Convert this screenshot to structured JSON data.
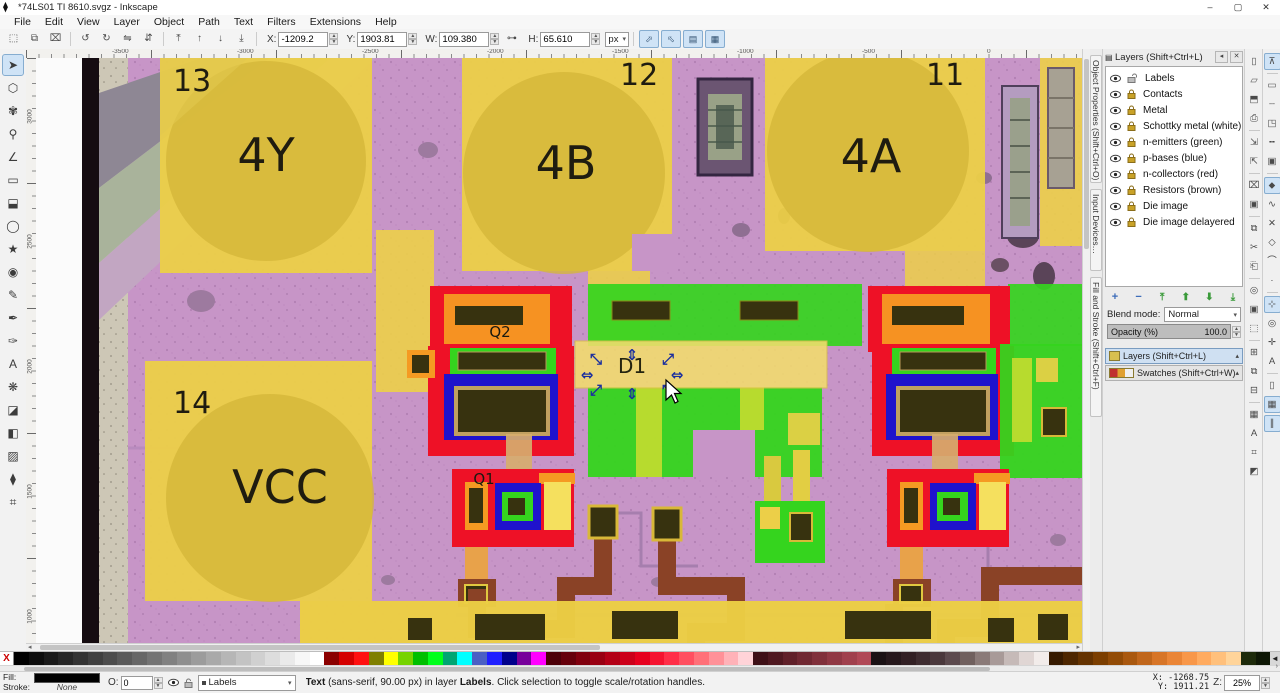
{
  "titlebar": {
    "title": "*74LS01 TI 8610.svgz - Inkscape",
    "minimize": "–",
    "maximize": "▢",
    "close": "✕",
    "appicon": "⧫"
  },
  "menubar": {
    "items": [
      "File",
      "Edit",
      "View",
      "Layer",
      "Object",
      "Path",
      "Text",
      "Filters",
      "Extensions",
      "Help"
    ]
  },
  "tool_controls": {
    "button_groups": [
      [
        {
          "name": "select-all",
          "glyph": "⬚"
        },
        {
          "name": "select-all-layers",
          "glyph": "⧉"
        },
        {
          "name": "deselect",
          "glyph": "⌧"
        }
      ],
      [
        {
          "name": "rotate-ccw",
          "glyph": "↺"
        },
        {
          "name": "rotate-cw",
          "glyph": "↻"
        },
        {
          "name": "flip-horizontal",
          "glyph": "⇋"
        },
        {
          "name": "flip-vertical",
          "glyph": "⇵"
        }
      ],
      [
        {
          "name": "raise-to-top",
          "glyph": "⤒"
        },
        {
          "name": "raise",
          "glyph": "↑"
        },
        {
          "name": "lower",
          "glyph": "↓"
        },
        {
          "name": "lower-to-bottom",
          "glyph": "⤓"
        }
      ]
    ],
    "fields": [
      {
        "name": "x-field",
        "label": "X:",
        "value": "-1209.2"
      },
      {
        "name": "y-field",
        "label": "Y:",
        "value": "1903.81"
      },
      {
        "name": "w-field",
        "label": "W:",
        "value": "109.380"
      },
      {
        "name": "h-field",
        "label": "H:",
        "value": "65.610"
      }
    ],
    "ratio_lock_glyph": "⊶",
    "unit": "px",
    "scale_toggles": [
      {
        "name": "scale-stroke-toggle",
        "glyph": "⬀"
      },
      {
        "name": "scale-corners-toggle",
        "glyph": "⬁"
      },
      {
        "name": "scale-gradients-toggle",
        "glyph": "▤"
      },
      {
        "name": "scale-patterns-toggle",
        "glyph": "▦"
      }
    ]
  },
  "toolbox": {
    "tools": [
      {
        "name": "selector-tool",
        "glyph": "➤",
        "active": true
      },
      {
        "name": "node-editor-tool",
        "glyph": "⬡",
        "active": false
      },
      {
        "name": "tweak-tool",
        "glyph": "✾",
        "active": false
      },
      {
        "name": "zoom-tool",
        "glyph": "⚲",
        "active": false
      },
      {
        "name": "measure-tool",
        "glyph": "∠",
        "active": false
      },
      {
        "name": "rectangle-tool",
        "glyph": "▭",
        "active": false
      },
      {
        "name": "box-3d-tool",
        "glyph": "⬓",
        "active": false
      },
      {
        "name": "ellipse-tool",
        "glyph": "◯",
        "active": false
      },
      {
        "name": "star-tool",
        "glyph": "★",
        "active": false
      },
      {
        "name": "spiral-tool",
        "glyph": "◉",
        "active": false
      },
      {
        "name": "pencil-tool",
        "glyph": "✎",
        "active": false
      },
      {
        "name": "bezier-pen-tool",
        "glyph": "✒",
        "active": false
      },
      {
        "name": "calligraphy-tool",
        "glyph": "✑",
        "active": false
      },
      {
        "name": "text-tool",
        "glyph": "A",
        "active": false
      },
      {
        "name": "spray-tool",
        "glyph": "❋",
        "active": false
      },
      {
        "name": "eraser-tool",
        "glyph": "◪",
        "active": false
      },
      {
        "name": "paint-bucket-tool",
        "glyph": "◧",
        "active": false
      },
      {
        "name": "gradient-tool",
        "glyph": "▨",
        "active": false
      },
      {
        "name": "dropper-tool",
        "glyph": "⧫",
        "active": false
      },
      {
        "name": "connector-tool",
        "glyph": "⌗",
        "active": false
      }
    ]
  },
  "canvas": {
    "labels": {
      "pad13_num": "13",
      "pad13_name": "4Y",
      "pad12_num": "12",
      "pad12_name": "4B",
      "pad11_num": "11",
      "pad11_name": "4A",
      "pad14_num": "14",
      "pad14_name": "VCC",
      "q1": "Q1",
      "q2": "Q2",
      "d1": "D1"
    },
    "selection": {
      "handles": [
        "⤡",
        "⇕",
        "⤢",
        "⇔",
        "⇔",
        "⤢",
        "⇕",
        "⤡"
      ]
    },
    "hruler_labels": [
      {
        "text": "-3500",
        "x": 84
      },
      {
        "text": "-3000",
        "x": 209
      },
      {
        "text": "-2500",
        "x": 334
      },
      {
        "text": "-2000",
        "x": 459
      },
      {
        "text": "-1500",
        "x": 584
      },
      {
        "text": "-1000",
        "x": 709
      },
      {
        "text": "-500",
        "x": 834
      },
      {
        "text": "0",
        "x": 959
      }
    ],
    "vruler_labels": [
      {
        "text": "3000",
        "y": 55
      },
      {
        "text": "2500",
        "y": 180
      },
      {
        "text": "2000",
        "y": 305
      },
      {
        "text": "1500",
        "y": 430
      },
      {
        "text": "1000",
        "y": 555
      }
    ]
  },
  "side_tabs": [
    {
      "name": "tab-object-properties",
      "label": "Object Properties (Shift+Ctrl+O)"
    },
    {
      "name": "tab-input-devices",
      "label": "Input Devices…"
    },
    {
      "name": "tab-fill-and-stroke",
      "label": "Fill and Stroke (Shift+Ctrl+F)"
    }
  ],
  "layers_panel": {
    "title": "Layers (Shift+Ctrl+L)",
    "collapse_btn": "◂",
    "close_btn": "✕",
    "layers": [
      {
        "name": "Labels",
        "locked": false,
        "visible": true
      },
      {
        "name": "Contacts",
        "locked": true,
        "visible": true
      },
      {
        "name": "Metal",
        "locked": true,
        "visible": true
      },
      {
        "name": "Schottky metal (white)",
        "locked": true,
        "visible": true
      },
      {
        "name": "n-emitters (green)",
        "locked": true,
        "visible": true
      },
      {
        "name": "p-bases (blue)",
        "locked": true,
        "visible": true
      },
      {
        "name": "n-collectors (red)",
        "locked": true,
        "visible": true
      },
      {
        "name": "Resistors (brown)",
        "locked": true,
        "visible": true
      },
      {
        "name": "Die image",
        "locked": true,
        "visible": true
      },
      {
        "name": "Die image delayered",
        "locked": true,
        "visible": true
      }
    ],
    "list_buttons": [
      {
        "name": "add-layer-button",
        "glyph": "+",
        "color": "blue"
      },
      {
        "name": "remove-layer-button",
        "glyph": "−",
        "color": "blue"
      },
      {
        "name": "raise-layer-top-button",
        "glyph": "⤒",
        "color": "green"
      },
      {
        "name": "raise-layer-button",
        "glyph": "⬆",
        "color": "green"
      },
      {
        "name": "lower-layer-button",
        "glyph": "⬇",
        "color": "green"
      },
      {
        "name": "lower-layer-bottom-button",
        "glyph": "⤓",
        "color": "green"
      }
    ],
    "blend_label": "Blend mode:",
    "blend_value": "Normal",
    "opacity_label": "Opacity (%)",
    "opacity_value": "100.0",
    "docks": [
      {
        "name": "dock-layers",
        "label": "Layers (Shift+Ctrl+L)",
        "active": true
      },
      {
        "name": "dock-swatches",
        "label": "Swatches (Shift+Ctrl+W)",
        "active": false
      }
    ]
  },
  "commands_bar": {
    "items": [
      {
        "name": "new-document",
        "glyph": "▯"
      },
      {
        "name": "open-document",
        "glyph": "▱"
      },
      {
        "name": "save-document",
        "glyph": "⬒"
      },
      {
        "name": "print-document",
        "glyph": "⎙"
      },
      {
        "sep": true
      },
      {
        "name": "import-bitmap",
        "glyph": "⇲"
      },
      {
        "name": "export-bitmap",
        "glyph": "⇱"
      },
      {
        "sep": true
      },
      {
        "name": "close-document",
        "glyph": "⌧"
      },
      {
        "name": "document-properties",
        "glyph": "▣"
      },
      {
        "sep": true
      },
      {
        "name": "copy",
        "glyph": "⧉"
      },
      {
        "name": "cut",
        "glyph": "✂"
      },
      {
        "name": "paste",
        "glyph": "⎗"
      },
      {
        "sep": true
      },
      {
        "name": "zoom-drawing",
        "glyph": "◎"
      },
      {
        "name": "zoom-page",
        "glyph": "▣"
      },
      {
        "name": "zoom-selection",
        "glyph": "⬚"
      },
      {
        "sep": true
      },
      {
        "name": "duplicate",
        "glyph": "⊞"
      },
      {
        "name": "create-clone",
        "glyph": "⧉"
      },
      {
        "name": "unlink-clone",
        "glyph": "⊟"
      },
      {
        "sep": true
      },
      {
        "name": "group-objects",
        "glyph": "▦"
      },
      {
        "name": "text-and-font",
        "glyph": "A"
      },
      {
        "name": "xml-editor",
        "glyph": "⌗"
      },
      {
        "name": "fill-stroke-dialog",
        "glyph": "◩"
      }
    ]
  },
  "snap_bar": {
    "items": [
      {
        "name": "snap-enabled",
        "glyph": "⊼",
        "active": true
      },
      {
        "sep": true
      },
      {
        "name": "snap-bounding-box",
        "glyph": "▭"
      },
      {
        "name": "snap-bbox-edges",
        "glyph": "┄"
      },
      {
        "name": "snap-bbox-corners",
        "glyph": "◳"
      },
      {
        "name": "snap-bbox-edge-midpoints",
        "glyph": "╍"
      },
      {
        "name": "snap-bbox-centers",
        "glyph": "▣"
      },
      {
        "sep": true
      },
      {
        "name": "snap-nodes",
        "glyph": "⬥",
        "active": true
      },
      {
        "name": "snap-paths",
        "glyph": "∿"
      },
      {
        "name": "snap-path-intersections",
        "glyph": "✕"
      },
      {
        "name": "snap-cusp-nodes",
        "glyph": "◇"
      },
      {
        "name": "snap-smooth-nodes",
        "glyph": "⌒"
      },
      {
        "name": "snap-line-midpoints",
        "glyph": "·"
      },
      {
        "sep": true
      },
      {
        "name": "snap-others",
        "glyph": "⊹",
        "active": true
      },
      {
        "name": "snap-object-centers",
        "glyph": "◎"
      },
      {
        "name": "snap-rotation-centers",
        "glyph": "✛"
      },
      {
        "name": "snap-text-baseline",
        "glyph": "A"
      },
      {
        "sep": true
      },
      {
        "name": "snap-page-border",
        "glyph": "▯"
      },
      {
        "name": "snap-grids",
        "glyph": "▦",
        "active": true
      },
      {
        "name": "snap-guides",
        "glyph": "∥",
        "active": true
      }
    ]
  },
  "palette": {
    "none_glyph": "X",
    "scroll_arrow": "◄",
    "colors": [
      "#000000",
      "#0d0d0d",
      "#1a1a1a",
      "#262626",
      "#333333",
      "#404040",
      "#4d4d4d",
      "#5a5a5a",
      "#676767",
      "#747474",
      "#818181",
      "#8f8f8f",
      "#9c9c9c",
      "#a9a9a9",
      "#b6b6b6",
      "#c3c3c3",
      "#d0d0d0",
      "#dddddd",
      "#eaeaea",
      "#f7f7f7",
      "#ffffff",
      "#8b0000",
      "#d40000",
      "#ff1010",
      "#7f7f00",
      "#ffff00",
      "#76d300",
      "#00bf00",
      "#00ff1c",
      "#00a572",
      "#00ffff",
      "#4a5fc4",
      "#1f1fff",
      "#00008b",
      "#77009b",
      "#ff00ff",
      "#4d0008",
      "#66000b",
      "#80000e",
      "#990012",
      "#b30016",
      "#cc001a",
      "#e6001e",
      "#f51330",
      "#ff2e48",
      "#ff4f60",
      "#ff7078",
      "#ff9198",
      "#ffb2b8",
      "#ffd3d8",
      "#3f1017",
      "#4f1820",
      "#602029",
      "#702832",
      "#80303b",
      "#903844",
      "#a0404d",
      "#b04856",
      "#1a1114",
      "#26181c",
      "#322024",
      "#3e2c30",
      "#4a383c",
      "#5c4a4e",
      "#70605e",
      "#8a7a78",
      "#a89a98",
      "#c6bab8",
      "#e0d6d4",
      "#f2ecea",
      "#361a00",
      "#4d2600",
      "#643200",
      "#7b3e00",
      "#924b06",
      "#a9580f",
      "#c0661b",
      "#d77527",
      "#ea8536",
      "#f89749",
      "#ffab60",
      "#ffc07c",
      "#ffd49a",
      "#1d2a0a",
      "#0e1705"
    ]
  },
  "statusbar": {
    "fill_label": "Fill:",
    "stroke_label": "Stroke:",
    "stroke_value": "None",
    "opacity_label": "O:",
    "opacity_value": "0",
    "layer_name": "Labels",
    "message_prefix": "Text",
    "message_mid": " (sans-serif, 90.00 px) in layer ",
    "message_layer": "Labels",
    "message_suffix": ". Click selection to toggle scale/rotation handles.",
    "coord_x_label": "X:",
    "coord_x": "-1268.75",
    "coord_y_label": "Y:",
    "coord_y": "1911.21",
    "zoom_label": "Z:",
    "zoom_value": "25%"
  }
}
